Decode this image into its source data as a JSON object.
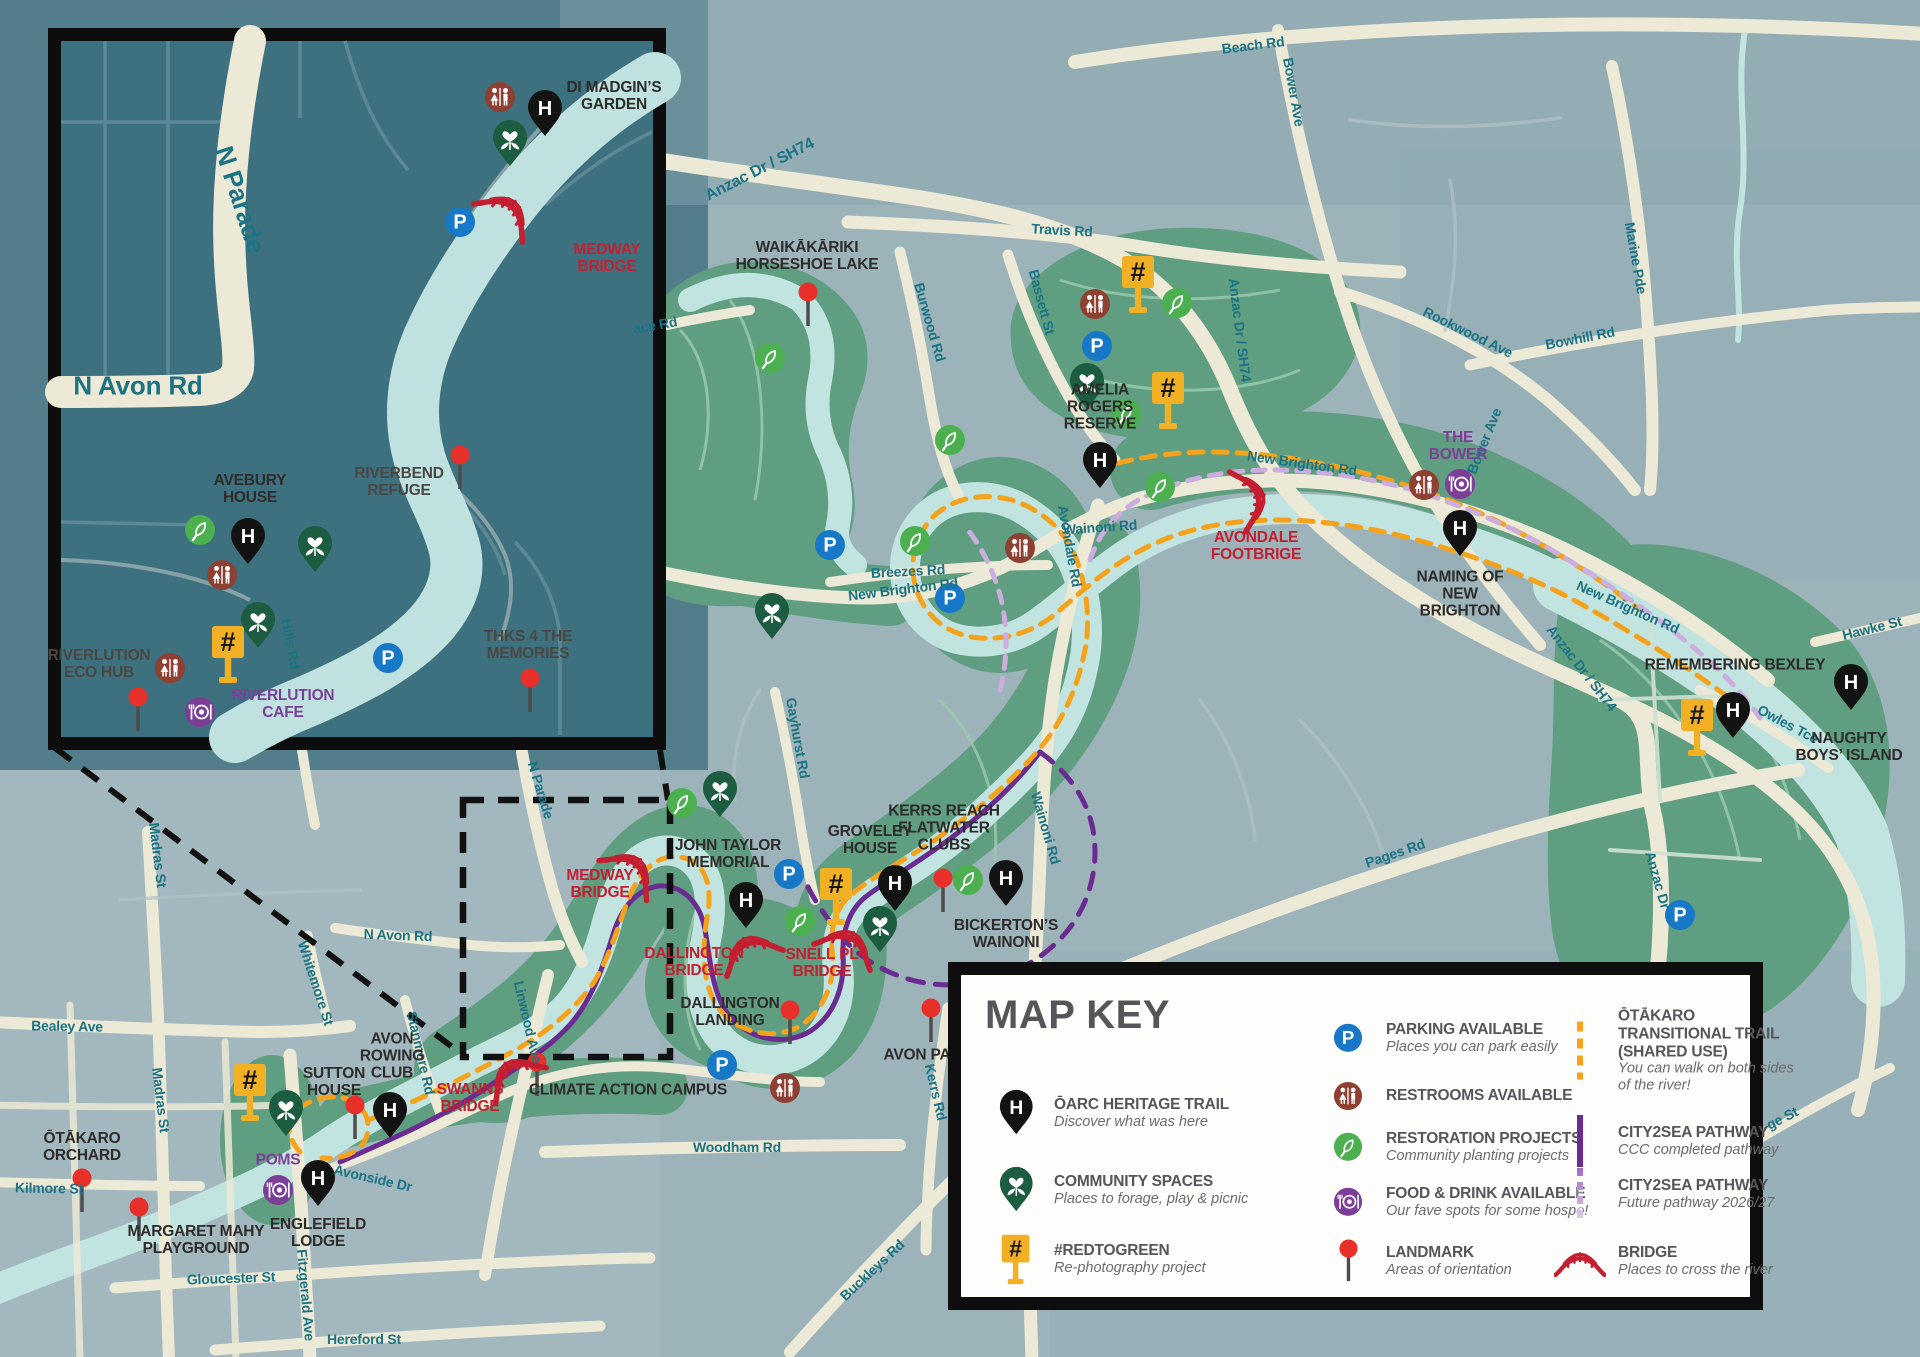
{
  "map_key": {
    "title": "MAP KEY",
    "items": [
      {
        "icon": "heritage",
        "label": "ŌARC HERITAGE TRAIL",
        "desc": "Discover what was here",
        "col": 1,
        "x": 16,
        "y": 125
      },
      {
        "icon": "community",
        "label": "COMMUNITY SPACES",
        "desc": "Places to forage, play & picnic",
        "col": 1,
        "x": 16,
        "y": 202
      },
      {
        "icon": "redtogreen",
        "label": "#REDTOGREEN",
        "desc": "Re-photography project",
        "col": 1,
        "x": 16,
        "y": 271
      },
      {
        "icon": "parking",
        "label": "PARKING AVAILABLE",
        "desc": "Places you can park easily",
        "col": 2,
        "x": 348,
        "y": 50
      },
      {
        "icon": "restroom",
        "label": "RESTROOMS AVAILABLE",
        "desc": "",
        "col": 2,
        "x": 348,
        "y": 108
      },
      {
        "icon": "restoration",
        "label": "RESTORATION PROJECTS",
        "desc": "Community planting projects",
        "col": 2,
        "x": 348,
        "y": 159
      },
      {
        "icon": "food",
        "label": "FOOD & DRINK AVAILABLE",
        "desc": "Our fave spots for some hospo!",
        "col": 2,
        "x": 348,
        "y": 214
      },
      {
        "icon": "landmark",
        "label": "LANDMARK",
        "desc": "Areas of orientation",
        "col": 2,
        "x": 348,
        "y": 273
      },
      {
        "icon": "trail-orange",
        "label": "ŌTĀKARO TRANSITIONAL TRAIL (SHARED USE)",
        "desc": "You can walk on both sides of the river!",
        "col": 3,
        "x": 580,
        "y": 63
      },
      {
        "icon": "trail-purple",
        "label": "CITY2SEA PATHWAY",
        "desc": "CCC completed pathway",
        "col": 3,
        "x": 580,
        "y": 153
      },
      {
        "icon": "trail-lilac",
        "label": "CITY2SEA PATHWAY",
        "desc": "Future pathway 2026/27",
        "col": 3,
        "x": 580,
        "y": 206
      },
      {
        "icon": "bridge",
        "label": "BRIDGE",
        "desc": "Places to cross the river",
        "col": 3,
        "x": 580,
        "y": 273
      }
    ]
  },
  "labels": {
    "road": [
      {
        "id": "beach",
        "text": "Beach Rd",
        "x": 1253,
        "y": 45,
        "rot": -7
      },
      {
        "id": "bower-north",
        "text": "Bower Ave",
        "x": 1294,
        "y": 92,
        "rot": 80
      },
      {
        "id": "anzac-top",
        "text": "Anzac Dr / SH74",
        "x": 760,
        "y": 170,
        "rot": -27,
        "size": 16
      },
      {
        "id": "travis",
        "text": "Travis Rd",
        "x": 1062,
        "y": 230,
        "rot": 3
      },
      {
        "id": "bassett",
        "text": "Bassett St",
        "x": 1042,
        "y": 302,
        "rot": 75
      },
      {
        "id": "burwood",
        "text": "Burwood Rd",
        "x": 930,
        "y": 322,
        "rot": 74
      },
      {
        "id": "rookwood",
        "text": "Rookwood Ave",
        "x": 1468,
        "y": 332,
        "rot": 26
      },
      {
        "id": "bowhill",
        "text": "Bowhill Rd",
        "x": 1580,
        "y": 338,
        "rot": -11
      },
      {
        "id": "marine",
        "text": "Marine Pde",
        "x": 1636,
        "y": 258,
        "rot": 80
      },
      {
        "id": "ace",
        "text": "ace Rd",
        "x": 655,
        "y": 325,
        "rot": -10
      },
      {
        "id": "new-brighton-w",
        "text": "New Brighton Rd",
        "x": 903,
        "y": 589,
        "rot": -7
      },
      {
        "id": "new-brighton-mid",
        "text": "New Brighton Rd",
        "x": 1302,
        "y": 463,
        "rot": 8
      },
      {
        "id": "new-brighton-e",
        "text": "New Brighton Rd",
        "x": 1628,
        "y": 607,
        "rot": 24
      },
      {
        "id": "anzac-mid",
        "text": "Anzac Dr / SH74",
        "x": 1240,
        "y": 330,
        "rot": 83
      },
      {
        "id": "anzac-se",
        "text": "Anzac Dr / SH74",
        "x": 1582,
        "y": 668,
        "rot": 52
      },
      {
        "id": "wainoni-h",
        "text": "Wainoni Rd",
        "x": 1100,
        "y": 527,
        "rot": -4
      },
      {
        "id": "wainoni-v",
        "text": "Wainoni Rd",
        "x": 1046,
        "y": 828,
        "rot": 74
      },
      {
        "id": "breezes",
        "text": "Breezes Rd",
        "x": 908,
        "y": 571,
        "rot": -3
      },
      {
        "id": "avondale",
        "text": "Avondale Rd",
        "x": 1070,
        "y": 546,
        "rot": 80
      },
      {
        "id": "bower-south",
        "text": "Bower Ave",
        "x": 1484,
        "y": 441,
        "rot": -68
      },
      {
        "id": "hawke",
        "text": "Hawke St",
        "x": 1872,
        "y": 628,
        "rot": -14
      },
      {
        "id": "owles",
        "text": "Owles Tce",
        "x": 1788,
        "y": 724,
        "rot": 28
      },
      {
        "id": "pages",
        "text": "Pages Rd",
        "x": 1395,
        "y": 853,
        "rot": -19
      },
      {
        "id": "anzac-s",
        "text": "Anzac Dr",
        "x": 1658,
        "y": 880,
        "rot": 74
      },
      {
        "id": "kerrs",
        "text": "Kerrs Rd",
        "x": 936,
        "y": 1092,
        "rot": 77
      },
      {
        "id": "buckleys",
        "text": "Buckleys Rd",
        "x": 872,
        "y": 1270,
        "rot": -43
      },
      {
        "id": "woodham",
        "text": "Woodham Rd",
        "x": 737,
        "y": 1147,
        "rot": 0
      },
      {
        "id": "linwood",
        "text": "Linwood Ave",
        "x": 528,
        "y": 1022,
        "rot": 77
      },
      {
        "id": "gayhurst",
        "text": "Gayhurst Rd",
        "x": 798,
        "y": 738,
        "rot": 80
      },
      {
        "id": "n-parade-main",
        "text": "N Parade",
        "x": 541,
        "y": 790,
        "rot": 73
      },
      {
        "id": "n-avon-main",
        "text": "N Avon Rd",
        "x": 398,
        "y": 935,
        "rot": 2
      },
      {
        "id": "whitemore",
        "text": "Whitemore St",
        "x": 316,
        "y": 983,
        "rot": 72
      },
      {
        "id": "stanmore",
        "text": "Stanmore Rd",
        "x": 421,
        "y": 1053,
        "rot": 77
      },
      {
        "id": "madras-n",
        "text": "Madras St",
        "x": 158,
        "y": 855,
        "rot": 83
      },
      {
        "id": "madras-s",
        "text": "Madras St",
        "x": 161,
        "y": 1100,
        "rot": 83
      },
      {
        "id": "bealey",
        "text": "Bealey Ave",
        "x": 67,
        "y": 1026,
        "rot": 1
      },
      {
        "id": "kilmore",
        "text": "Kilmore St",
        "x": 49,
        "y": 1188,
        "rot": 1
      },
      {
        "id": "gloucester",
        "text": "Gloucester St",
        "x": 231,
        "y": 1278,
        "rot": -2
      },
      {
        "id": "hereford",
        "text": "Hereford St",
        "x": 364,
        "y": 1339,
        "rot": 0
      },
      {
        "id": "fitzgerald",
        "text": "Fitzgerald Ave",
        "x": 306,
        "y": 1295,
        "rot": 85
      },
      {
        "id": "hills",
        "text": "Hills Rd",
        "x": 291,
        "y": 644,
        "rot": 80
      },
      {
        "id": "avonside",
        "text": "Avonside Dr",
        "x": 373,
        "y": 1178,
        "rot": 13
      },
      {
        "id": "ge-st",
        "text": "ge St",
        "x": 1782,
        "y": 1118,
        "rot": -27
      },
      {
        "id": "inset-n-parade",
        "text": "N Parade",
        "x": 240,
        "y": 200,
        "rot": 72,
        "size": 26
      },
      {
        "id": "inset-n-avon",
        "text": "N Avon Rd",
        "x": 138,
        "y": 386,
        "rot": 0,
        "size": 26
      }
    ],
    "poi": [
      {
        "id": "waikakariki",
        "text": "WAIKĀKĀRIKI HORSESHOE LAKE",
        "x": 807,
        "y": 256,
        "w": 150
      },
      {
        "id": "amelia-rogers",
        "text": "AMELIA ROGERS RESERVE",
        "x": 1100,
        "y": 407,
        "w": 110
      },
      {
        "id": "the-bower",
        "text": "THE BOWER",
        "x": 1458,
        "y": 446,
        "w": 90,
        "color": "#7c3f98"
      },
      {
        "id": "naming-of-new-brighton",
        "text": "NAMING OF NEW BRIGHTON",
        "x": 1460,
        "y": 594,
        "w": 120
      },
      {
        "id": "avondale-footbrige",
        "text": "AVONDALE FOOTBRIGE",
        "x": 1256,
        "y": 546,
        "w": 160,
        "color": "#c41f30"
      },
      {
        "id": "remembering-bexley",
        "text": "REMEMBERING BEXLEY",
        "x": 1735,
        "y": 665,
        "w": 250
      },
      {
        "id": "naughty-boys-island",
        "text": "NAUGHTY BOYS’ ISLAND",
        "x": 1849,
        "y": 747,
        "w": 110
      },
      {
        "id": "kerrs-reach",
        "text": "KERRS REACH FLATWATER CLUBS",
        "x": 944,
        "y": 828,
        "w": 120
      },
      {
        "id": "groveley-house",
        "text": "GROVELEY HOUSE",
        "x": 870,
        "y": 840,
        "w": 110
      },
      {
        "id": "bickertons-wainoni",
        "text": "BICKERTON’S WAINONI",
        "x": 1006,
        "y": 934,
        "w": 150
      },
      {
        "id": "john-taylor-memorial",
        "text": "JOHN TAYLOR MEMORIAL",
        "x": 728,
        "y": 854,
        "w": 160
      },
      {
        "id": "medway-bridge-main",
        "text": "MEDWAY BRIDGE",
        "x": 600,
        "y": 884,
        "w": 100,
        "color": "#c41f30"
      },
      {
        "id": "dallington-bridge",
        "text": "DALLINGTON BRIDGE",
        "x": 694,
        "y": 962,
        "w": 135,
        "color": "#c41f30"
      },
      {
        "id": "snell-pl-bridge",
        "text": "SNELL PL BRIDGE",
        "x": 822,
        "y": 963,
        "w": 100,
        "color": "#c41f30"
      },
      {
        "id": "dallington-landing",
        "text": "DALLINGTON LANDING",
        "x": 730,
        "y": 1012,
        "w": 140
      },
      {
        "id": "avon-park",
        "text": "AVON PARK",
        "x": 928,
        "y": 1055,
        "w": 120
      },
      {
        "id": "climate-action-campus",
        "text": "CLIMATE ACTION CAMPUS",
        "x": 628,
        "y": 1090,
        "w": 215
      },
      {
        "id": "sutton-house",
        "text": "SUTTON HOUSE",
        "x": 334,
        "y": 1082,
        "w": 100
      },
      {
        "id": "avon-rowing-club",
        "text": "AVON ROWING CLUB",
        "x": 392,
        "y": 1056,
        "w": 90
      },
      {
        "id": "swanns-bridge",
        "text": "SWANNS BRIDGE",
        "x": 470,
        "y": 1098,
        "w": 90,
        "color": "#c41f30"
      },
      {
        "id": "poms",
        "text": "POMS",
        "x": 278,
        "y": 1160,
        "w": 70,
        "color": "#7c3f98"
      },
      {
        "id": "englefield-lodge",
        "text": "ENGLEFIELD LODGE",
        "x": 318,
        "y": 1233,
        "w": 120
      },
      {
        "id": "otakaro-orchard",
        "text": "ŌTĀKARO ORCHARD",
        "x": 82,
        "y": 1147,
        "w": 110
      },
      {
        "id": "margaret-mahy-playground",
        "text": "MARGARET MAHY PLAYGROUND",
        "x": 196,
        "y": 1240,
        "w": 140
      },
      {
        "id": "di-madgins-garden",
        "text": "DI MADGIN’S GARDEN",
        "x": 614,
        "y": 96,
        "w": 110
      },
      {
        "id": "medway-bridge-inset",
        "text": "MEDWAY BRIDGE",
        "x": 607,
        "y": 258,
        "w": 100,
        "color": "#c41f30"
      },
      {
        "id": "avebury-house",
        "text": "AVEBURY HOUSE",
        "x": 250,
        "y": 489,
        "w": 105
      },
      {
        "id": "riverbend-refuge",
        "text": "RIVERBEND REFUGE",
        "x": 399,
        "y": 482,
        "w": 140,
        "color": "#4a4743"
      },
      {
        "id": "riverlution-eco-hub",
        "text": "RIVERLUTION ECO HUB",
        "x": 99,
        "y": 664,
        "w": 130,
        "color": "#4a4743"
      },
      {
        "id": "riverlution-cafe",
        "text": "RIVERLUTION CAFE",
        "x": 283,
        "y": 704,
        "w": 125,
        "color": "#7c3f98"
      },
      {
        "id": "thks-4-the-memories",
        "text": "THKS 4 THE MEMORIES",
        "x": 528,
        "y": 645,
        "w": 150,
        "color": "#4a4743"
      }
    ]
  },
  "markers": [
    {
      "type": "landmark",
      "x": 808,
      "y": 292
    },
    {
      "type": "heritage",
      "x": 1100,
      "y": 488
    },
    {
      "type": "restoration",
      "x": 1160,
      "y": 487
    },
    {
      "type": "restroom",
      "x": 1020,
      "y": 548
    },
    {
      "type": "redtogreen",
      "x": 1138,
      "y": 272
    },
    {
      "type": "restroom",
      "x": 1095,
      "y": 304
    },
    {
      "type": "parking",
      "x": 1097,
      "y": 346
    },
    {
      "type": "community",
      "x": 1087,
      "y": 409
    },
    {
      "type": "restoration",
      "x": 1126,
      "y": 414
    },
    {
      "type": "restoration",
      "x": 1177,
      "y": 303
    },
    {
      "type": "redtogreen",
      "x": 1168,
      "y": 388
    },
    {
      "type": "restoration",
      "x": 770,
      "y": 358
    },
    {
      "type": "restoration",
      "x": 950,
      "y": 440
    },
    {
      "type": "restoration",
      "x": 915,
      "y": 541
    },
    {
      "type": "parking",
      "x": 830,
      "y": 545
    },
    {
      "type": "parking",
      "x": 950,
      "y": 598
    },
    {
      "type": "community",
      "x": 772,
      "y": 639
    },
    {
      "type": "bridge",
      "x": 1256,
      "y": 497,
      "rot": 75
    },
    {
      "type": "restroom",
      "x": 1424,
      "y": 485
    },
    {
      "type": "food",
      "x": 1460,
      "y": 484
    },
    {
      "type": "heritage",
      "x": 1460,
      "y": 556
    },
    {
      "type": "redtogreen",
      "x": 1697,
      "y": 715
    },
    {
      "type": "heritage",
      "x": 1733,
      "y": 738
    },
    {
      "type": "heritage",
      "x": 1851,
      "y": 710
    },
    {
      "type": "parking",
      "x": 1680,
      "y": 915
    },
    {
      "type": "landmark",
      "x": 943,
      "y": 878
    },
    {
      "type": "restoration",
      "x": 968,
      "y": 880
    },
    {
      "type": "heritage",
      "x": 895,
      "y": 911
    },
    {
      "type": "heritage",
      "x": 1006,
      "y": 906
    },
    {
      "type": "heritage",
      "x": 746,
      "y": 928
    },
    {
      "type": "parking",
      "x": 789,
      "y": 874
    },
    {
      "type": "redtogreen",
      "x": 836,
      "y": 884
    },
    {
      "type": "community",
      "x": 720,
      "y": 817
    },
    {
      "type": "restoration",
      "x": 682,
      "y": 803
    },
    {
      "type": "bridge",
      "x": 635,
      "y": 866,
      "rot": 40
    },
    {
      "type": "bridge",
      "x": 747,
      "y": 946,
      "rot": -25
    },
    {
      "type": "bridge",
      "x": 850,
      "y": 940,
      "rot": 25
    },
    {
      "type": "community",
      "x": 880,
      "y": 952
    },
    {
      "type": "restoration",
      "x": 800,
      "y": 921
    },
    {
      "type": "landmark",
      "x": 790,
      "y": 1010
    },
    {
      "type": "parking",
      "x": 722,
      "y": 1065
    },
    {
      "type": "restroom",
      "x": 785,
      "y": 1088
    },
    {
      "type": "landmark",
      "x": 931,
      "y": 1008
    },
    {
      "type": "landmark",
      "x": 537,
      "y": 1062
    },
    {
      "type": "bridge",
      "x": 510,
      "y": 1070,
      "rot": -35
    },
    {
      "type": "landmark",
      "x": 355,
      "y": 1105
    },
    {
      "type": "heritage",
      "x": 390,
      "y": 1138
    },
    {
      "type": "heritage",
      "x": 318,
      "y": 1206
    },
    {
      "type": "food",
      "x": 278,
      "y": 1190
    },
    {
      "type": "redtogreen",
      "x": 250,
      "y": 1080
    },
    {
      "type": "community",
      "x": 286,
      "y": 1136
    },
    {
      "type": "landmark",
      "x": 82,
      "y": 1178
    },
    {
      "type": "landmark",
      "x": 139,
      "y": 1207
    },
    {
      "type": "restroom",
      "x": 500,
      "y": 97
    },
    {
      "type": "heritage",
      "x": 545,
      "y": 136
    },
    {
      "type": "community",
      "x": 510,
      "y": 166
    },
    {
      "type": "bridge",
      "x": 510,
      "y": 208,
      "rot": 38
    },
    {
      "type": "parking",
      "x": 460,
      "y": 222
    },
    {
      "type": "landmark",
      "x": 460,
      "y": 455
    },
    {
      "type": "restoration",
      "x": 200,
      "y": 530
    },
    {
      "type": "heritage",
      "x": 248,
      "y": 564
    },
    {
      "type": "community",
      "x": 315,
      "y": 572
    },
    {
      "type": "restroom",
      "x": 222,
      "y": 575
    },
    {
      "type": "community",
      "x": 258,
      "y": 648
    },
    {
      "type": "redtogreen",
      "x": 228,
      "y": 642
    },
    {
      "type": "restroom",
      "x": 170,
      "y": 668
    },
    {
      "type": "landmark",
      "x": 138,
      "y": 697
    },
    {
      "type": "food",
      "x": 200,
      "y": 712
    },
    {
      "type": "parking",
      "x": 388,
      "y": 658
    },
    {
      "type": "landmark",
      "x": 530,
      "y": 678
    }
  ]
}
